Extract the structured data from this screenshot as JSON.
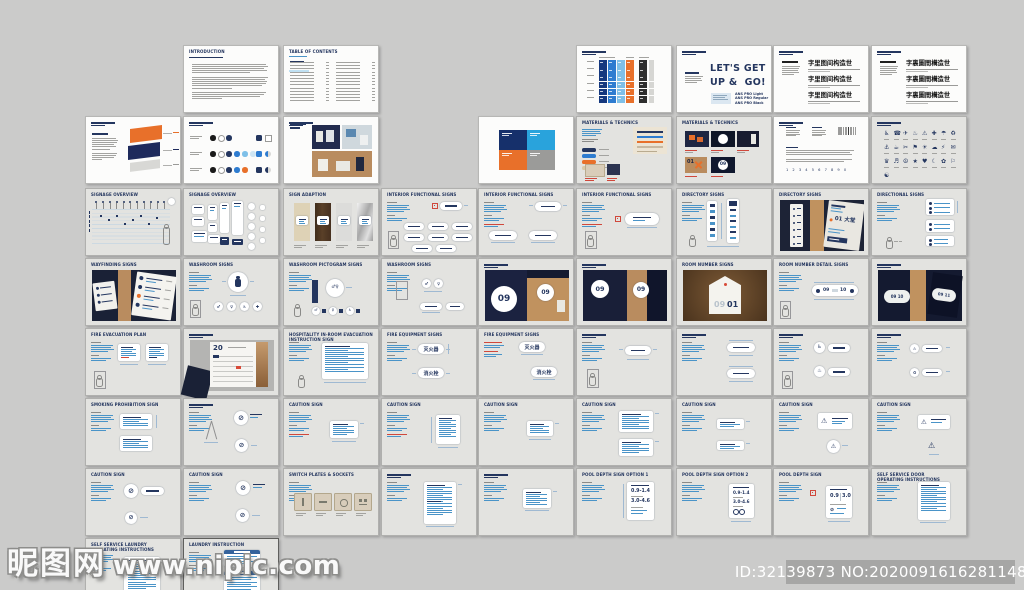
{
  "meta": {
    "watermark_site": "昵图网",
    "watermark_url": "www.nipic.com",
    "id_text": "ID:32139873 NO:20200916162811485000"
  },
  "colors": {
    "canvas": "#cbcbca",
    "navy": "#24365f",
    "blue": "#4a94c8",
    "orange": "#e8702a",
    "red": "#d0483c",
    "tan": "#c0925f",
    "page_white": "#fcfcfb",
    "page_gray": "#e3e3e0"
  },
  "grid": {
    "col_x": [
      85,
      183,
      283,
      381,
      478,
      576,
      676,
      773,
      871
    ],
    "row_y": [
      45,
      116,
      188,
      258,
      328,
      398,
      468,
      538
    ],
    "page_w": 96,
    "page_h": 68
  },
  "pages": [
    {
      "r": 0,
      "c": 1,
      "bg": "w",
      "k": "doc",
      "title": "INTRODUCTION"
    },
    {
      "r": 0,
      "c": 2,
      "bg": "w",
      "k": "toc",
      "title": "TABLE OF CONTENTS"
    },
    {
      "r": 0,
      "c": 5,
      "bg": "w",
      "k": "palette",
      "title": ""
    },
    {
      "r": 0,
      "c": 6,
      "bg": "w",
      "k": "typeEn",
      "title": "",
      "big": "LET'S GET\nUP &  GO!",
      "fonts": [
        "ANS PRO Light",
        "ANS PRO Regular",
        "ANS PRO Black"
      ]
    },
    {
      "r": 0,
      "c": 7,
      "bg": "w",
      "k": "typeCn",
      "title": "",
      "specimen": "字里图间构造世"
    },
    {
      "r": 0,
      "c": 8,
      "bg": "w",
      "k": "typeCn",
      "title": "",
      "specimen": "字裏圖間構造世"
    },
    {
      "r": 1,
      "c": 0,
      "bg": "w",
      "k": "logo3d",
      "title": ""
    },
    {
      "r": 1,
      "c": 1,
      "bg": "w",
      "k": "dots",
      "title": ""
    },
    {
      "r": 1,
      "c": 2,
      "bg": "w",
      "k": "collage",
      "title": ""
    },
    {
      "r": 1,
      "c": 4,
      "bg": "w",
      "k": "blocks4"
    },
    {
      "r": 1,
      "c": 5,
      "bg": "g",
      "k": "materials",
      "title": "MATERIALS & TECHNICS"
    },
    {
      "r": 1,
      "c": 6,
      "bg": "g",
      "k": "matPhotos",
      "title": "MATERIALS & TECHNICS",
      "nums": [
        "01",
        "09"
      ]
    },
    {
      "r": 1,
      "c": 7,
      "bg": "w",
      "k": "typeSpec",
      "title": "",
      "digits": "1 2 3 4 5 6 7 8 9 0"
    },
    {
      "r": 1,
      "c": 8,
      "bg": "g",
      "k": "icons",
      "title": ""
    },
    {
      "r": 2,
      "c": 0,
      "bg": "g",
      "k": "elev",
      "title": "SIGNAGE OVERVIEW"
    },
    {
      "r": 2,
      "c": 1,
      "bg": "g",
      "k": "sigGrid",
      "title": "SIGNAGE OVERVIEW"
    },
    {
      "r": 2,
      "c": 2,
      "bg": "g",
      "k": "swatches",
      "title": "SIGN ADAPTION"
    },
    {
      "r": 2,
      "c": 3,
      "bg": "g",
      "k": "spec",
      "v": "pills8",
      "title": "INTERIOR FUNCTIONAL SIGNS"
    },
    {
      "r": 2,
      "c": 4,
      "bg": "g",
      "k": "spec",
      "v": "pills3red",
      "title": "INTERIOR FUNCTIONAL SIGNS"
    },
    {
      "r": 2,
      "c": 5,
      "bg": "g",
      "k": "spec",
      "v": "pillRed",
      "title": "INTERIOR FUNCTIONAL SIGNS"
    },
    {
      "r": 2,
      "c": 6,
      "bg": "g",
      "k": "dirSpec",
      "title": "DIRECTORY SIGNS"
    },
    {
      "r": 2,
      "c": 7,
      "bg": "g",
      "k": "photoDir",
      "title": "DIRECTORY SIGNS",
      "label": "01 大堂"
    },
    {
      "r": 2,
      "c": 8,
      "bg": "g",
      "k": "dirlSpec",
      "title": "DIRECTIONAL SIGNS"
    },
    {
      "r": 3,
      "c": 0,
      "bg": "g",
      "k": "photoPlaques",
      "title": "WAYFINDING SIGNS"
    },
    {
      "r": 3,
      "c": 1,
      "bg": "g",
      "k": "spec",
      "v": "washA",
      "title": "WASHROOM SIGNS"
    },
    {
      "r": 3,
      "c": 2,
      "bg": "g",
      "k": "spec",
      "v": "washB",
      "title": "WASHROOM PICTOGRAM SIGNS"
    },
    {
      "r": 3,
      "c": 3,
      "bg": "g",
      "k": "spec",
      "v": "washC",
      "title": "WASHROOM SIGNS"
    },
    {
      "r": 3,
      "c": 4,
      "bg": "g",
      "k": "photo09",
      "title": "",
      "nums": [
        "09",
        "09"
      ]
    },
    {
      "r": 3,
      "c": 5,
      "bg": "g",
      "k": "photo09b",
      "title": "",
      "nums": [
        "09",
        "09"
      ]
    },
    {
      "r": 3,
      "c": 6,
      "bg": "g",
      "k": "photoTag",
      "title": "ROOM NUMBER SIGNS",
      "num_gray": "09",
      "num_navy": "01"
    },
    {
      "r": 3,
      "c": 7,
      "bg": "g",
      "k": "spec",
      "v": "roomnum",
      "title": "ROOM NUMBER DETAIL SIGNS",
      "nums": [
        "09",
        "10"
      ]
    },
    {
      "r": 3,
      "c": 8,
      "bg": "g",
      "k": "photoOvals",
      "title": "",
      "nums": [
        "09 10",
        "09 11"
      ]
    },
    {
      "r": 4,
      "c": 0,
      "bg": "g",
      "k": "spec",
      "v": "evac",
      "title": "FIRE EVACUATION PLAN"
    },
    {
      "r": 4,
      "c": 1,
      "bg": "g",
      "k": "photo20",
      "title": "",
      "num": "20"
    },
    {
      "r": 4,
      "c": 2,
      "bg": "g",
      "k": "spec",
      "v": "textcardP",
      "title": "HOSPITALITY IN-ROOM EVACUATION\nINSTRUCTION SIGN"
    },
    {
      "r": 4,
      "c": 3,
      "bg": "g",
      "k": "spec",
      "v": "fire2",
      "title": "FIRE EQUIPMENT SIGNS",
      "labels": [
        "灭火器",
        "消火栓"
      ]
    },
    {
      "r": 4,
      "c": 4,
      "bg": "g",
      "k": "spec",
      "v": "fireRed",
      "title": "FIRE EQUIPMENT SIGNS",
      "labels": [
        "灭火器",
        "消火栓"
      ]
    },
    {
      "r": 4,
      "c": 5,
      "bg": "g",
      "k": "spec",
      "v": "pillPerson",
      "title": ""
    },
    {
      "r": 4,
      "c": 6,
      "bg": "g",
      "k": "spec",
      "v": "pills2v",
      "title": ""
    },
    {
      "r": 4,
      "c": 7,
      "bg": "g",
      "k": "spec",
      "v": "circPills",
      "title": ""
    },
    {
      "r": 4,
      "c": 8,
      "bg": "g",
      "k": "spec",
      "v": "circPills2",
      "title": ""
    },
    {
      "r": 5,
      "c": 0,
      "bg": "g",
      "k": "spec",
      "v": "prohibit",
      "title": "SMOKING PROHIBITION SIGN"
    },
    {
      "r": 5,
      "c": 1,
      "bg": "g",
      "k": "spec",
      "v": "aframe",
      "title": ""
    },
    {
      "r": 5,
      "c": 2,
      "bg": "g",
      "k": "spec",
      "v": "caution1",
      "title": "CAUTION SIGN"
    },
    {
      "r": 5,
      "c": 3,
      "bg": "g",
      "k": "spec",
      "v": "caution2",
      "title": "CAUTION SIGN"
    },
    {
      "r": 5,
      "c": 4,
      "bg": "g",
      "k": "spec",
      "v": "caution3",
      "title": "CAUTION SIGN"
    },
    {
      "r": 5,
      "c": 5,
      "bg": "g",
      "k": "spec",
      "v": "cards2",
      "title": "CAUTION SIGN"
    },
    {
      "r": 5,
      "c": 6,
      "bg": "g",
      "k": "spec",
      "v": "cards2small",
      "title": "CAUTION SIGN"
    },
    {
      "r": 5,
      "c": 7,
      "bg": "g",
      "k": "spec",
      "v": "tri",
      "title": "CAUTION SIGN"
    },
    {
      "r": 5,
      "c": 8,
      "bg": "g",
      "k": "spec",
      "v": "tri2",
      "title": "CAUTION SIGN"
    },
    {
      "r": 6,
      "c": 0,
      "bg": "g",
      "k": "spec",
      "v": "nosmoke2",
      "title": "CAUTION SIGN"
    },
    {
      "r": 6,
      "c": 1,
      "bg": "g",
      "k": "spec",
      "v": "nosmoke1",
      "title": "CAUTION SIGN"
    },
    {
      "r": 6,
      "c": 2,
      "bg": "g",
      "k": "spec",
      "v": "switches",
      "title": "SWITCH PLATES & SOCKETS"
    },
    {
      "r": 6,
      "c": 3,
      "bg": "g",
      "k": "spec",
      "v": "textcardTall",
      "title": ""
    },
    {
      "r": 6,
      "c": 4,
      "bg": "g",
      "k": "spec",
      "v": "textcard",
      "title": ""
    },
    {
      "r": 6,
      "c": 5,
      "bg": "g",
      "k": "spec",
      "v": "depth1",
      "title": "POOL DEPTH SIGN OPTION 1",
      "depths": [
        "0.9-1.4",
        "3.0-4.6"
      ]
    },
    {
      "r": 6,
      "c": 6,
      "bg": "g",
      "k": "spec",
      "v": "depth2",
      "title": "POOL DEPTH SIGN OPTION 2",
      "depths": [
        "0.9-1.4",
        "3.0-4.6"
      ]
    },
    {
      "r": 6,
      "c": 7,
      "bg": "g",
      "k": "spec",
      "v": "depth3",
      "title": "POOL DEPTH SIGN",
      "depths": [
        "0.9",
        "3.0"
      ]
    },
    {
      "r": 6,
      "c": 8,
      "bg": "g",
      "k": "spec",
      "v": "textcard2",
      "title": "SELF SERVICE DOOR\nOPERATING INSTRUCTIONS"
    },
    {
      "r": 7,
      "c": 0,
      "bg": "g",
      "k": "spec",
      "v": "laundryA",
      "title": "SELF SERVICE LAUNDRY\nOPERATING INSTRUCTIONS"
    },
    {
      "r": 7,
      "c": 1,
      "bg": "g",
      "k": "spec",
      "v": "laundryB",
      "title": "LAUNDRY INSTRUCTION",
      "sel": true
    }
  ]
}
